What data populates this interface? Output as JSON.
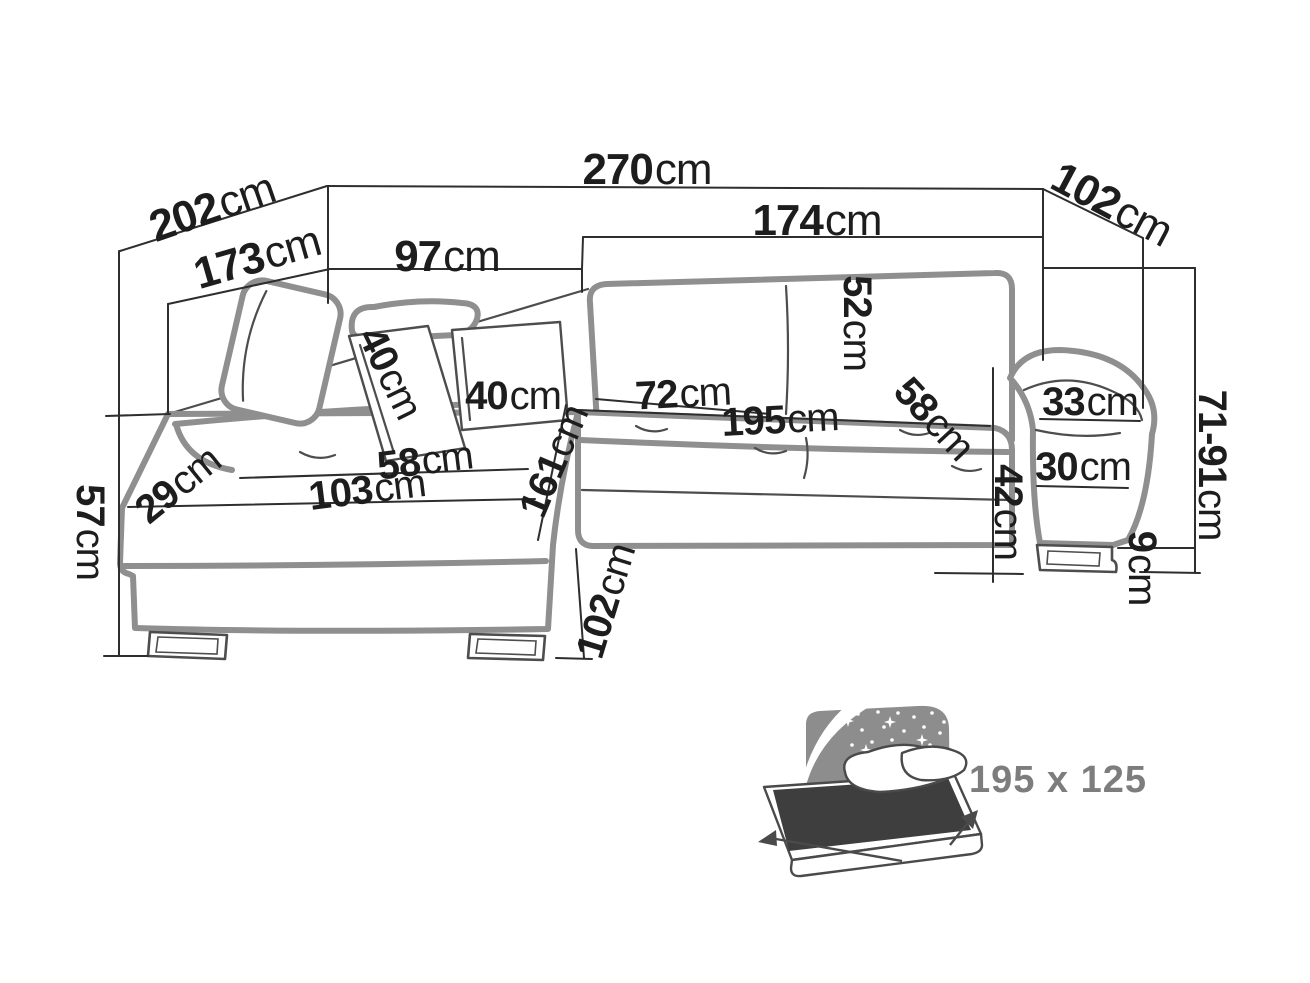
{
  "diagram": {
    "type": "corner-sofa-dimension-drawing",
    "unit_system": "cm"
  },
  "dims": [
    {
      "name": "total-width",
      "value": "270",
      "unit": "cm"
    },
    {
      "name": "side-depth",
      "value": "202",
      "unit": "cm"
    },
    {
      "name": "chaise-length",
      "value": "173",
      "unit": "cm"
    },
    {
      "name": "back-width-left",
      "value": "97",
      "unit": "cm"
    },
    {
      "name": "back-width-right",
      "value": "174",
      "unit": "cm"
    },
    {
      "name": "end-depth",
      "value": "102",
      "unit": "cm"
    },
    {
      "name": "backrest-height",
      "value": "52",
      "unit": "cm"
    },
    {
      "name": "cushion-a",
      "value": "40",
      "unit": "cm"
    },
    {
      "name": "cushion-b",
      "value": "40",
      "unit": "cm"
    },
    {
      "name": "seat-depth",
      "value": "72",
      "unit": "cm"
    },
    {
      "name": "bed-length",
      "value": "195",
      "unit": "cm"
    },
    {
      "name": "seat-front-width",
      "value": "58",
      "unit": "cm"
    },
    {
      "name": "armrest-top-width",
      "value": "33",
      "unit": "cm"
    },
    {
      "name": "armrest-height",
      "value": "30",
      "unit": "cm"
    },
    {
      "name": "seat-height",
      "value": "42",
      "unit": "cm"
    },
    {
      "name": "back-height-range",
      "value": "71-91",
      "unit": "cm"
    },
    {
      "name": "leg-height",
      "value": "9",
      "unit": "cm"
    },
    {
      "name": "armrest-back-width",
      "value": "29",
      "unit": "cm"
    },
    {
      "name": "side-height",
      "value": "57",
      "unit": "cm"
    },
    {
      "name": "chaise-seat-width",
      "value": "58",
      "unit": "cm"
    },
    {
      "name": "chaise-seat-length",
      "value": "103",
      "unit": "cm"
    },
    {
      "name": "chaise-total-length",
      "value": "161",
      "unit": "cm"
    },
    {
      "name": "chaise-front-width",
      "value": "102",
      "unit": "cm"
    }
  ],
  "sleeping_area": {
    "caption": "195 x 125"
  }
}
